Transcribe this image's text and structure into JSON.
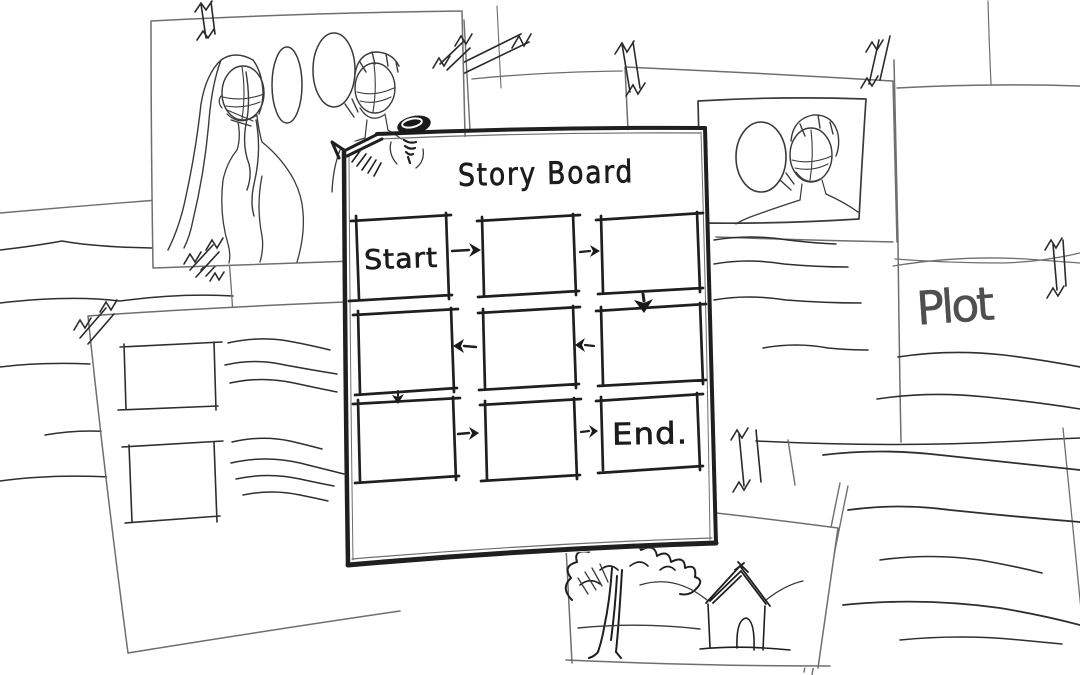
{
  "scene": {
    "background_color": "#ffffff",
    "ink_color": "#1f1f1f",
    "pencil_color": "#4f4f4f",
    "style": "hand-drawn-storyboard-wall-sketch"
  },
  "storyboard": {
    "title": "Story Board",
    "start_label": "Start",
    "end_label": "End.",
    "grid": {
      "rows": 3,
      "cols": 3,
      "cell_labels": [
        [
          "Start",
          "",
          ""
        ],
        [
          "",
          "",
          ""
        ],
        [
          "",
          "",
          "End."
        ]
      ],
      "arrow_directions": [
        "right",
        "right",
        "down",
        "left",
        "left",
        "down",
        "right",
        "right"
      ]
    },
    "pin_icon": "push-pin-icon"
  },
  "papers": {
    "plot_label": "Plot",
    "dialogue_thumbnail": "two-characters-with-speech-bubbles",
    "closeup_thumbnail": "character-with-speech-bubble",
    "scene_thumbnail": "tree-and-house",
    "script_page": "two-frames-with-text-lines",
    "note_lines": "scribbled-text-lines",
    "tape_icon": "tape-scribble-icon"
  }
}
